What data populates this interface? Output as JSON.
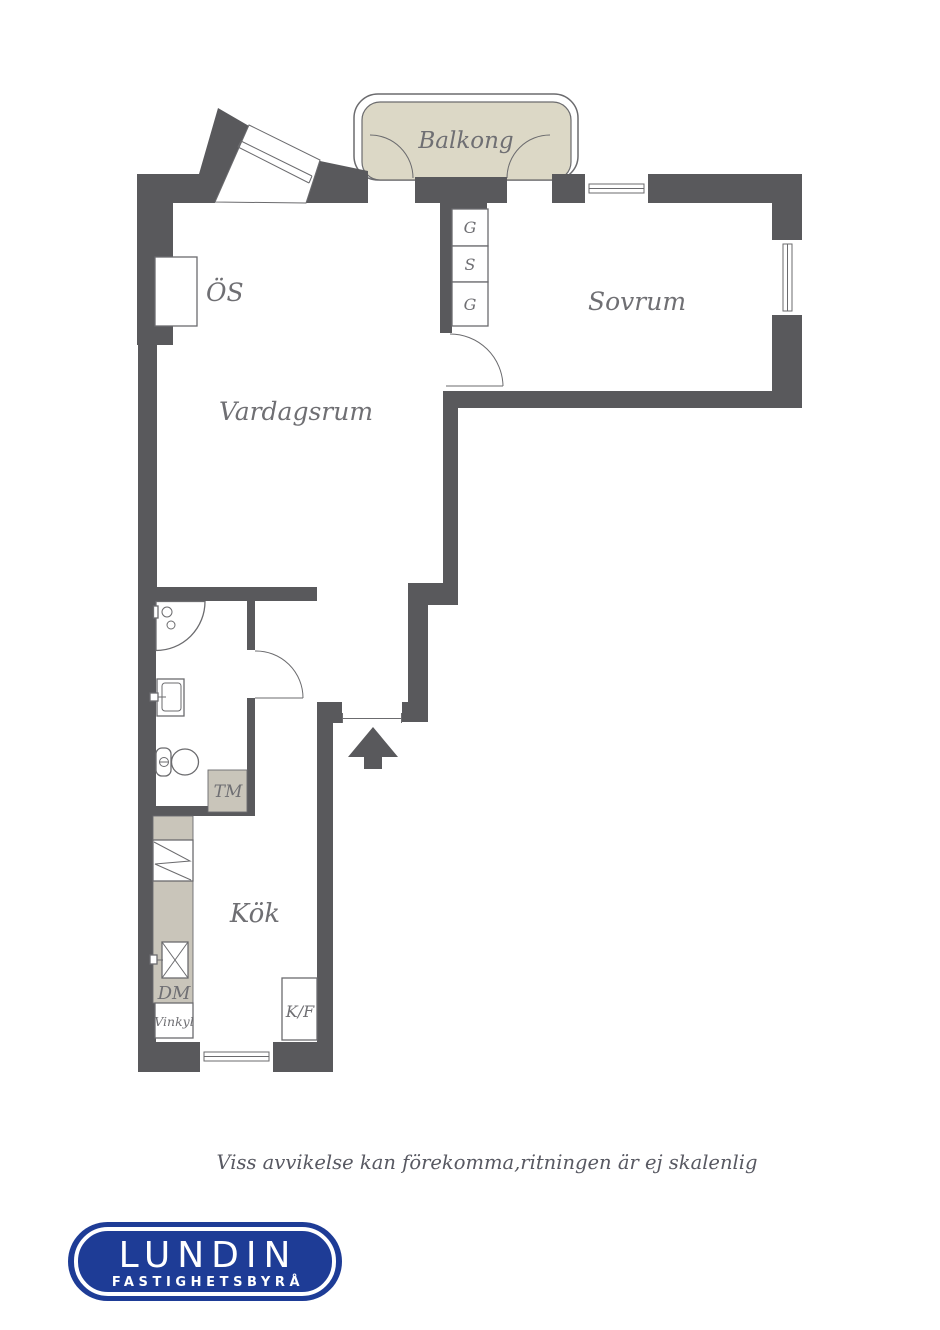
{
  "floorplan": {
    "rooms": {
      "balcony": "Balkong",
      "bedroom": "Sovrum",
      "living_room": "Vardagsrum",
      "kitchen": "Kök"
    },
    "closets": [
      "G",
      "S",
      "G"
    ],
    "fixtures": {
      "fireplace": "ÖS",
      "washing_machine": "TM",
      "dishwasher": "DM",
      "wine_cooler": "Vinkyl",
      "fridge_freezer": "K/F"
    },
    "disclaimer": "Viss avvikelse kan förekomma,ritningen är ej skalenlig",
    "logo": {
      "title": "LUNDIN",
      "subtitle": "FASTIGHETSBYRÅ"
    },
    "colors": {
      "wall": "#59595c",
      "line": "#6b6b6e",
      "balcony_fill": "#dcd8c6",
      "appliance_fill": "#c9c5ba",
      "label": "#6f6f73",
      "disclaimer": "#585962",
      "logo_blue": "#1e3c96"
    }
  }
}
